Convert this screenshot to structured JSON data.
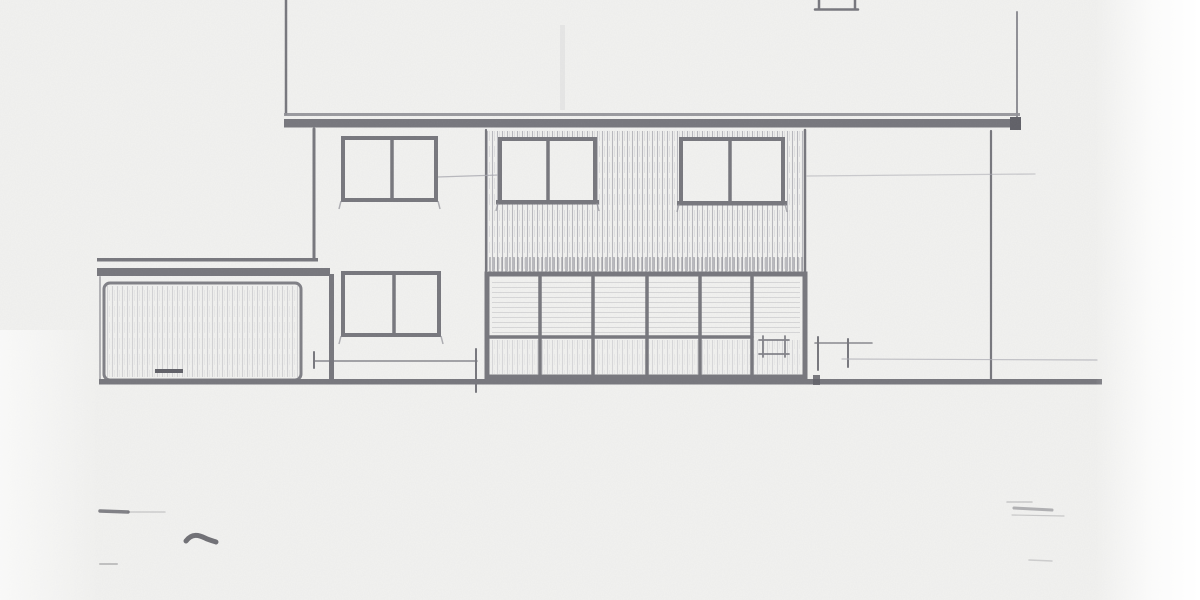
{
  "drawing": {
    "description": "Scanned pencil architectural elevation: two-storey house with overhanging eaves fascia, four two-pane casement windows, vertical tile-hung cladding band, full-width glazed ground-floor screen, attached flat-roof garage with door at left, ground line and dimension tick marks",
    "palette": {
      "paper": "#f2f2f0",
      "dark": "#76767c",
      "darker": "#5f5f66",
      "medium": "#8f8f95",
      "mediumdark": "#7f7f85",
      "faint": "#a9a9b0",
      "ink": "#4e4e55"
    },
    "primitives": [
      {
        "name": "upper-wall-left-edge",
        "kind": "line",
        "x1": 286,
        "y1": 0,
        "x2": 286,
        "y2": 114,
        "w": 2.5,
        "c": "dark"
      },
      {
        "name": "upper-wall-right-edge",
        "kind": "line",
        "x1": 1017,
        "y1": 12,
        "x2": 1017,
        "y2": 120,
        "w": 2,
        "c": "medium"
      },
      {
        "name": "attic-window-partial",
        "kind": "path",
        "d": "M819,0 L819,9 M855,0 L855,9 M815,9.5 L858,9.5",
        "stroke": "dark",
        "sw": 2.5
      },
      {
        "name": "upper-wall-smudge",
        "kind": "rect",
        "x": 560,
        "y": 25,
        "w": 5,
        "h": 85,
        "fill": "faint",
        "o": 0.15
      },
      {
        "name": "eaves-fascia-top-line",
        "kind": "rect",
        "x": 284,
        "y": 113,
        "w": 736,
        "h": 3,
        "fill": "medium",
        "o": 0.9
      },
      {
        "name": "eaves-fascia-band",
        "kind": "rect",
        "x": 284,
        "y": 119,
        "w": 737,
        "h": 8.5,
        "fill": "dark"
      },
      {
        "name": "eaves-fascia-end-cap",
        "kind": "rect",
        "x": 1010,
        "y": 117,
        "w": 11,
        "h": 13,
        "fill": "darker"
      },
      {
        "name": "first-floor-left-wall-edge",
        "kind": "line",
        "x1": 314,
        "y1": 129,
        "x2": 314,
        "y2": 260,
        "w": 3,
        "c": "dark"
      },
      {
        "name": "tile-cladding-hatch",
        "kind": "hatch",
        "x": 487,
        "y": 131,
        "w": 317,
        "h": 140,
        "pattern": "hatch-v"
      },
      {
        "name": "tile-cladding-hatch-dense",
        "kind": "hatch",
        "x": 487,
        "y": 257,
        "w": 317,
        "h": 15,
        "pattern": "hatch-vd",
        "o": 0.9
      },
      {
        "name": "cladding-left-boundary",
        "kind": "line",
        "x1": 486,
        "y1": 130,
        "x2": 486,
        "y2": 274,
        "w": 2.2,
        "c": "dark"
      },
      {
        "name": "cladding-right-boundary",
        "kind": "line",
        "x1": 805,
        "y1": 130,
        "x2": 805,
        "y2": 272,
        "w": 2.5,
        "c": "dark"
      },
      {
        "name": "first-floor-right-wall-edge",
        "kind": "line",
        "x1": 991,
        "y1": 131,
        "x2": 991,
        "y2": 381,
        "w": 2.2,
        "c": "dark"
      },
      {
        "name": "head-height-construction-line-left",
        "kind": "line",
        "x1": 437,
        "y1": 177,
        "x2": 499,
        "y2": 175,
        "w": 1.2,
        "c": "faint",
        "o": 0.8
      },
      {
        "name": "head-height-construction-line-right",
        "kind": "line",
        "x1": 807,
        "y1": 176,
        "x2": 1035,
        "y2": 174,
        "w": 1.3,
        "c": "faint",
        "o": 0.55
      },
      {
        "name": "window-upper-left",
        "kind": "window",
        "x": 343,
        "y": 138,
        "w": 93,
        "h": 62,
        "mx": 392
      },
      {
        "name": "window-upper-middle",
        "kind": "window",
        "x": 500,
        "y": 139,
        "w": 95,
        "h": 63,
        "mx": 548,
        "sill": true
      },
      {
        "name": "window-upper-right",
        "kind": "window",
        "x": 681,
        "y": 139,
        "w": 102,
        "h": 64,
        "mx": 730,
        "sill": true
      },
      {
        "name": "window-lower-left",
        "kind": "window",
        "x": 343,
        "y": 273,
        "w": 96,
        "h": 62,
        "mx": 394
      },
      {
        "name": "glazed-screen-fill",
        "kind": "rect",
        "x": 487,
        "y": 274,
        "w": 318,
        "h": 103,
        "fill": "paper"
      },
      {
        "name": "glazed-screen-glass-shading-upper",
        "kind": "hatch",
        "x": 492,
        "y": 278,
        "w": 308,
        "h": 58,
        "pattern": "hatch-h",
        "o": 0.7
      },
      {
        "name": "glazed-screen-glass-shading-lower",
        "kind": "hatch",
        "x": 492,
        "y": 340,
        "w": 308,
        "h": 34,
        "pattern": "hatch-v",
        "o": 0.45
      },
      {
        "name": "glazed-screen-frame",
        "kind": "rect",
        "x": 487,
        "y": 274,
        "w": 318,
        "h": 103,
        "stroke": "dark",
        "sw": 5
      },
      {
        "name": "glazed-screen-mullion-1",
        "kind": "line",
        "x1": 540,
        "y1": 277,
        "x2": 540,
        "y2": 374,
        "w": 3.5,
        "c": "dark"
      },
      {
        "name": "glazed-screen-mullion-2",
        "kind": "line",
        "x1": 593,
        "y1": 277,
        "x2": 593,
        "y2": 374,
        "w": 3.5,
        "c": "dark"
      },
      {
        "name": "glazed-screen-mullion-3",
        "kind": "line",
        "x1": 647,
        "y1": 277,
        "x2": 647,
        "y2": 374,
        "w": 3.5,
        "c": "dark"
      },
      {
        "name": "glazed-screen-mullion-4",
        "kind": "line",
        "x1": 700,
        "y1": 277,
        "x2": 700,
        "y2": 374,
        "w": 3.5,
        "c": "dark"
      },
      {
        "name": "glazed-screen-mullion-5",
        "kind": "line",
        "x1": 752,
        "y1": 277,
        "x2": 752,
        "y2": 374,
        "w": 3.5,
        "c": "dark"
      },
      {
        "name": "glazed-screen-transom",
        "kind": "line",
        "x1": 490,
        "y1": 337,
        "x2": 752,
        "y2": 337,
        "w": 3.5,
        "c": "dark"
      },
      {
        "name": "glazed-screen-vent-detail",
        "kind": "path",
        "d": "M759,340 L789,340 M759,354 L789,354 M763,336 L763,357 M785,336 L785,357",
        "stroke": "dark",
        "sw": 1.8,
        "o": 0.9
      },
      {
        "name": "garage-roof-edge",
        "kind": "rect",
        "x": 97,
        "y": 258,
        "w": 221,
        "h": 3.5,
        "fill": "dark"
      },
      {
        "name": "garage-fascia-band",
        "kind": "rect",
        "x": 97,
        "y": 268,
        "w": 233,
        "h": 8,
        "fill": "dark"
      },
      {
        "name": "garage-right-corner-post",
        "kind": "rect",
        "x": 329,
        "y": 274,
        "w": 5,
        "h": 108,
        "fill": "dark"
      },
      {
        "name": "garage-left-edge",
        "kind": "line",
        "x1": 100,
        "y1": 277,
        "x2": 100,
        "y2": 380,
        "w": 2,
        "c": "medium",
        "o": 0.65
      },
      {
        "name": "garage-door",
        "kind": "rect",
        "x": 104,
        "y": 283,
        "w": 197,
        "h": 97,
        "rx": 6,
        "stroke": "mediumdark",
        "sw": 3
      },
      {
        "name": "garage-door-hatch",
        "kind": "hatch",
        "x": 107,
        "y": 286,
        "w": 191,
        "h": 91,
        "pattern": "hatch-v",
        "o": 0.55
      },
      {
        "name": "garage-door-handle",
        "kind": "rect",
        "x": 155,
        "y": 369,
        "w": 28,
        "h": 4,
        "fill": "darker"
      },
      {
        "name": "ground-line",
        "kind": "rect",
        "x": 99,
        "y": 379,
        "w": 1003,
        "h": 5.5,
        "fill": "dark"
      },
      {
        "name": "ground-line-tick-blob",
        "kind": "rect",
        "x": 813,
        "y": 375,
        "w": 7,
        "h": 10,
        "fill": "darker",
        "o": 0.85
      },
      {
        "name": "dimension-line-left",
        "kind": "line",
        "x1": 314,
        "y1": 361,
        "x2": 477,
        "y2": 361,
        "w": 1.6,
        "c": "dark",
        "o": 0.85
      },
      {
        "name": "dimension-tick-a",
        "kind": "line",
        "x1": 314,
        "y1": 352,
        "x2": 314,
        "y2": 368,
        "w": 2,
        "c": "dark"
      },
      {
        "name": "dimension-tick-b",
        "kind": "line",
        "x1": 476,
        "y1": 349,
        "x2": 476,
        "y2": 392,
        "w": 2,
        "c": "dark"
      },
      {
        "name": "dimension-line-right",
        "kind": "line",
        "x1": 815,
        "y1": 343,
        "x2": 872,
        "y2": 343,
        "w": 1.6,
        "c": "dark",
        "o": 0.85
      },
      {
        "name": "dimension-tick-c",
        "kind": "line",
        "x1": 818,
        "y1": 337,
        "x2": 818,
        "y2": 370,
        "w": 2,
        "c": "dark"
      },
      {
        "name": "dimension-tick-d",
        "kind": "line",
        "x1": 848,
        "y1": 339,
        "x2": 848,
        "y2": 367,
        "w": 2,
        "c": "dark"
      },
      {
        "name": "cill-construction-line-right",
        "kind": "line",
        "x1": 842,
        "y1": 359,
        "x2": 1097,
        "y2": 360,
        "w": 1.2,
        "c": "faint",
        "o": 0.7
      },
      {
        "name": "smudge-left-a",
        "kind": "line",
        "x1": 100,
        "y1": 511,
        "x2": 128,
        "y2": 512,
        "w": 3.5,
        "c": "ink",
        "o": 0.7
      },
      {
        "name": "smudge-left-a-tail",
        "kind": "line",
        "x1": 128,
        "y1": 512,
        "x2": 165,
        "y2": 512,
        "w": 1.5,
        "c": "ink",
        "o": 0.22
      },
      {
        "name": "smudge-squiggle",
        "kind": "path",
        "d": "M186,541 C192,533 199,535 205,538 C209,540 213,541 216,542",
        "stroke": "ink",
        "sw": 5,
        "o": 0.8
      },
      {
        "name": "smudge-left-b",
        "kind": "line",
        "x1": 100,
        "y1": 564,
        "x2": 117,
        "y2": 564,
        "w": 2,
        "c": "ink",
        "o": 0.3
      },
      {
        "name": "smudge-right-a",
        "kind": "line",
        "x1": 1014,
        "y1": 508,
        "x2": 1052,
        "y2": 510,
        "w": 3,
        "c": "ink",
        "o": 0.4
      },
      {
        "name": "smudge-right-b",
        "kind": "line",
        "x1": 1007,
        "y1": 502,
        "x2": 1032,
        "y2": 502,
        "w": 1.5,
        "c": "ink",
        "o": 0.25
      },
      {
        "name": "smudge-right-c",
        "kind": "line",
        "x1": 1012,
        "y1": 515,
        "x2": 1064,
        "y2": 516,
        "w": 1.2,
        "c": "ink",
        "o": 0.25
      },
      {
        "name": "smudge-right-d",
        "kind": "line",
        "x1": 1029,
        "y1": 560,
        "x2": 1052,
        "y2": 561,
        "w": 1.5,
        "c": "ink",
        "o": 0.22
      }
    ]
  }
}
